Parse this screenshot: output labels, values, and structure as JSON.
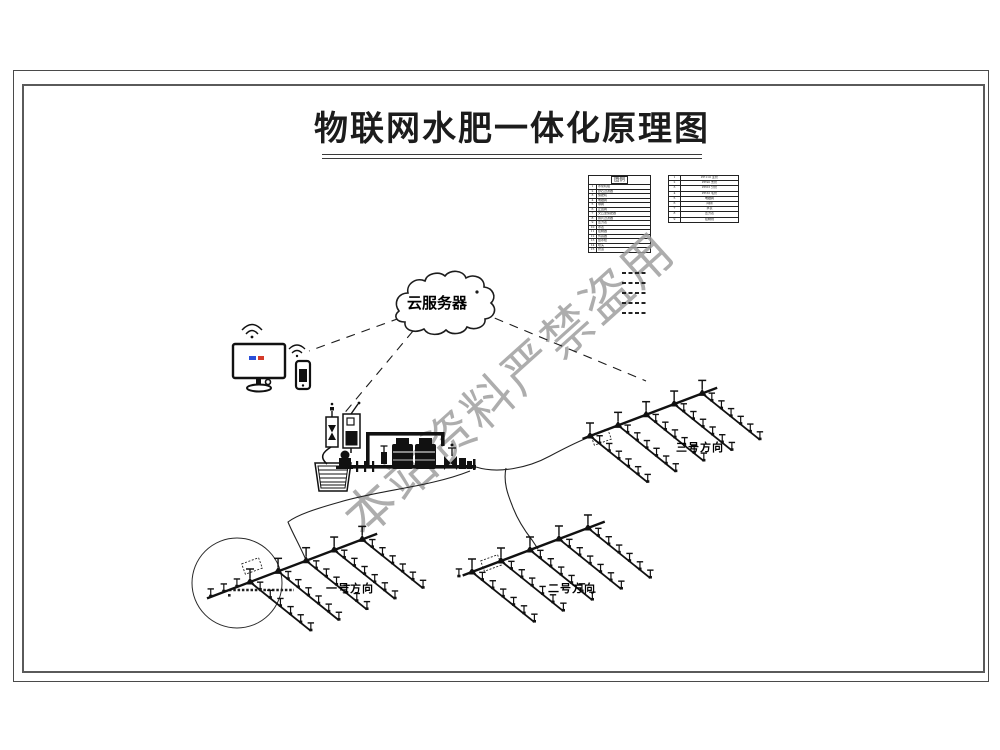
{
  "page": {
    "title": "物联网水肥一体化原理图",
    "watermark": "本站资料严禁盗用"
  },
  "cloud": {
    "label": "云服务器"
  },
  "fields": [
    {
      "id": 1,
      "label": "一号方向"
    },
    {
      "id": 2,
      "label": "二号方向"
    },
    {
      "id": 3,
      "label": "三号方向"
    }
  ],
  "legend_left": {
    "header": "图例",
    "rows": [
      {
        "no": "1",
        "name": "水泵机组"
      },
      {
        "no": "2",
        "name": "砂石过滤器"
      },
      {
        "no": "3",
        "name": "施肥机"
      },
      {
        "no": "4",
        "name": "电磁阀"
      },
      {
        "no": "5",
        "name": "球阀"
      },
      {
        "no": "6",
        "name": "止回阀"
      },
      {
        "no": "7",
        "name": "文丘里施肥器"
      },
      {
        "no": "8",
        "name": "叠片过滤器"
      },
      {
        "no": "9",
        "name": "压力表"
      },
      {
        "no": "10",
        "name": "水表"
      },
      {
        "no": "11",
        "name": "控制器"
      },
      {
        "no": "12",
        "name": "传感器"
      },
      {
        "no": "13",
        "name": "给水栓"
      },
      {
        "no": "14",
        "name": "喷头"
      },
      {
        "no": "15",
        "name": "管道"
      }
    ]
  },
  "legend_right": {
    "rows": [
      {
        "no": "1",
        "name": "PE110 主管"
      },
      {
        "no": "2",
        "name": "PE90 支管"
      },
      {
        "no": "3",
        "name": "PE63 分管"
      },
      {
        "no": "4",
        "name": "PE32 毛管"
      },
      {
        "no": "5",
        "name": "电磁阀"
      },
      {
        "no": "6",
        "name": "闸阀"
      },
      {
        "no": "7",
        "name": "水表"
      },
      {
        "no": "8",
        "name": "压力表"
      },
      {
        "no": "9",
        "name": "控制线"
      }
    ]
  },
  "line_samples": {
    "count": 5
  },
  "icons": {
    "cloud": "cloud-server-icon",
    "monitor": "monitor-icon",
    "phone": "phone-icon",
    "wifi": "wifi-icon",
    "tanks": "fertilizer-tank-icon",
    "pool": "water-pool-icon",
    "pump": "pump-icon",
    "filters": "filter-unit-icon",
    "sprinkler": "sprinkler-icon"
  },
  "colors": {
    "line": "#1c1c1c",
    "watermark": "#9c9c9c",
    "screen_blue": "#2b4fd8",
    "screen_red": "#d43a2a"
  }
}
